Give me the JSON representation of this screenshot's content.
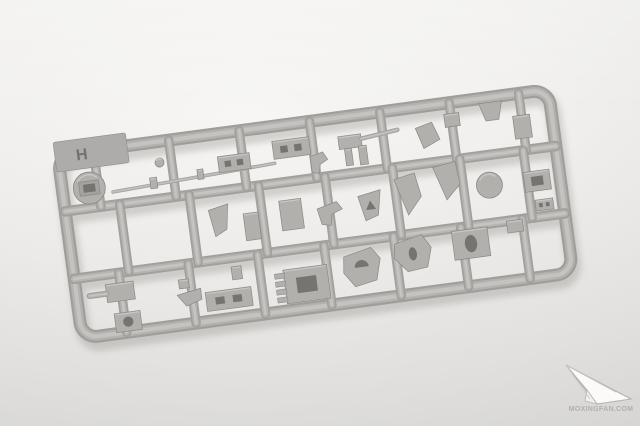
{
  "photo": {
    "subject": "gray injection-molded plastic model kit sprue on white backdrop",
    "plastic_color": "#b2b0ad",
    "plastic_dark": "#8b8986",
    "plastic_light": "#c9c7c4",
    "hole_color": "#76746f",
    "backdrop_color": "#efeeec",
    "shadow_color": "#83817d"
  },
  "sprue": {
    "letter": "H",
    "rotation_deg": -7.6,
    "origin": {
      "x": 57,
      "y": 150
    },
    "frame": {
      "w": 495,
      "top": 5,
      "bottom": 190,
      "rail_w": 13,
      "corner": 16
    },
    "rails": {
      "rail_w": 9.5,
      "horizontal_y": [
        62,
        130
      ],
      "bands": [
        {
          "y1": 5,
          "y2": 62,
          "xs": [
            36,
            112,
            183,
            254,
            325,
            395,
            465
          ]
        },
        {
          "y1": 62,
          "y2": 130,
          "xs": [
            55,
            125,
            195,
            262,
            330,
            398,
            462
          ]
        },
        {
          "y1": 130,
          "y2": 190,
          "xs": [
            45,
            115,
            185,
            252,
            322,
            390,
            452
          ]
        }
      ]
    },
    "parts": [
      {
        "name": "hatch-disc",
        "shape": "circle",
        "cx": 27,
        "cy": 42,
        "r": 16,
        "inner": "rect"
      },
      {
        "name": "barrel-rod",
        "shape": "rod",
        "x1": 50,
        "y1": 49,
        "x2": 214,
        "y2": 42,
        "w": 3.5
      },
      {
        "name": "rod-collar-a",
        "shape": "rect",
        "x": 88,
        "y": 40,
        "w": 7,
        "h": 11
      },
      {
        "name": "rod-collar-b",
        "shape": "rect",
        "x": 136,
        "y": 38,
        "w": 6,
        "h": 10
      },
      {
        "name": "knob",
        "shape": "circle",
        "cx": 100,
        "cy": 26,
        "r": 4.5
      },
      {
        "name": "receiver-box",
        "shape": "rect",
        "x": 158,
        "y": 28,
        "w": 32,
        "h": 16,
        "hole": "slots"
      },
      {
        "name": "vent-box",
        "shape": "rect",
        "x": 214,
        "y": 20,
        "w": 37,
        "h": 18,
        "hole": "slots"
      },
      {
        "name": "mg-body",
        "shape": "rect",
        "x": 280,
        "y": 24,
        "w": 23,
        "h": 13
      },
      {
        "name": "mg-barrel",
        "shape": "rod",
        "x1": 303,
        "y1": 29,
        "x2": 340,
        "y2": 25,
        "w": 4.5
      },
      {
        "name": "mg-leg-a",
        "shape": "rect",
        "x": 285,
        "y": 37,
        "w": 7,
        "h": 17
      },
      {
        "name": "mg-leg-b",
        "shape": "rect",
        "x": 299,
        "y": 36,
        "w": 8,
        "h": 19
      },
      {
        "name": "crank",
        "shape": "poly",
        "pts": "250,40 263,37 267,45 259,49 257,58 250,56"
      },
      {
        "name": "wedge-small",
        "shape": "poly",
        "pts": "358,26 375,22 381,40 364,47"
      },
      {
        "name": "box-small",
        "shape": "rect",
        "x": 388,
        "y": 16,
        "w": 15,
        "h": 13
      },
      {
        "name": "hopper",
        "shape": "poly",
        "pts": "424,10 447,10 442,28 429,28"
      },
      {
        "name": "tall-box",
        "shape": "rect",
        "x": 456,
        "y": 27,
        "w": 17,
        "h": 23
      },
      {
        "name": "down-wedge",
        "shape": "poly",
        "pts": "142,80 162,76 158,101 146,107"
      },
      {
        "name": "plate",
        "shape": "rect",
        "x": 176,
        "y": 88,
        "w": 15,
        "h": 27
      },
      {
        "name": "mid-box",
        "shape": "rect",
        "x": 213,
        "y": 80,
        "w": 22,
        "h": 30
      },
      {
        "name": "linkage",
        "shape": "poly",
        "pts": "250,93 270,88 275,96 264,100 262,111 253,109"
      },
      {
        "name": "wishbone",
        "shape": "poly",
        "pts": "292,86 315,82 310,107 297,111",
        "hole": "tri"
      },
      {
        "name": "shield-a",
        "shape": "poly",
        "pts": "330,74 351,70 355,94 340,111"
      },
      {
        "name": "shield-b",
        "shape": "poly",
        "pts": "370,67 393,64 395,87 380,101"
      },
      {
        "name": "disc",
        "shape": "circle",
        "cx": 424,
        "cy": 92,
        "r": 13
      },
      {
        "name": "right-box",
        "shape": "rect",
        "x": 459,
        "y": 84,
        "w": 26,
        "h": 20,
        "hole": "square"
      },
      {
        "name": "right-conn",
        "shape": "rect",
        "x": 467,
        "y": 113,
        "w": 18,
        "h": 11,
        "hole": "slots"
      },
      {
        "name": "nub-box",
        "shape": "rect",
        "x": 30,
        "y": 140,
        "w": 28,
        "h": 18
      },
      {
        "name": "nub-rod",
        "shape": "rod",
        "x1": 13,
        "y1": 149,
        "x2": 30,
        "y2": 149,
        "w": 6
      },
      {
        "name": "hole-box",
        "shape": "rect",
        "x": 35,
        "y": 170,
        "w": 26,
        "h": 19,
        "hole": "circle"
      },
      {
        "name": "angle",
        "shape": "poly",
        "pts": "100,160 124,156 124,167 108,172"
      },
      {
        "name": "stub",
        "shape": "rect",
        "x": 103,
        "y": 145,
        "w": 10,
        "h": 9
      },
      {
        "name": "long-box",
        "shape": "rect",
        "x": 128,
        "y": 161,
        "w": 46,
        "h": 19,
        "hole": "slots"
      },
      {
        "name": "cyl",
        "shape": "rect",
        "x": 157,
        "y": 139,
        "w": 10,
        "h": 13
      },
      {
        "name": "comb-box",
        "shape": "rect",
        "x": 208,
        "y": 149,
        "w": 44,
        "h": 34,
        "hole": "square",
        "teeth": true
      },
      {
        "name": "mount-d",
        "shape": "poly",
        "pts": "270,144 298,138 306,150 300,171 278,175 268,160",
        "hole": "d"
      },
      {
        "name": "rotor",
        "shape": "poly",
        "pts": "322,138 350,132 358,146 352,165 332,167 320,152",
        "hole": "oval"
      },
      {
        "name": "oval-box",
        "shape": "rect",
        "x": 380,
        "y": 133,
        "w": 36,
        "h": 29,
        "hole": "oval"
      },
      {
        "name": "end-conn",
        "shape": "rect",
        "x": 436,
        "y": 130,
        "w": 16,
        "h": 12
      }
    ]
  },
  "watermark": {
    "icon": "paper-airplane-icon",
    "site_label": "MOXINGFAN.COM"
  }
}
